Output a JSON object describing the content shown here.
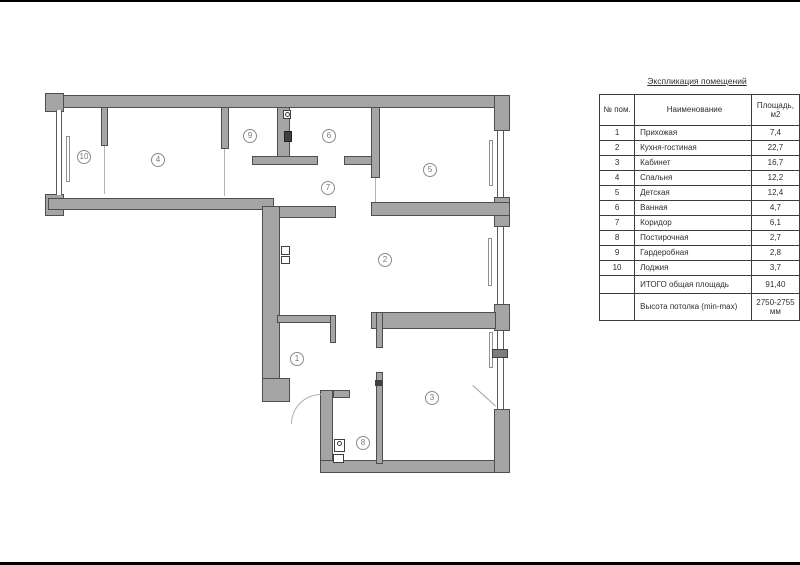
{
  "title": "Экспликация помещений",
  "plan": {
    "labels": [
      {
        "num": "10"
      },
      {
        "num": "4"
      },
      {
        "num": "9"
      },
      {
        "num": "6"
      },
      {
        "num": "5"
      },
      {
        "num": "7"
      },
      {
        "num": "2"
      },
      {
        "num": "1"
      },
      {
        "num": "8"
      },
      {
        "num": "3"
      }
    ]
  },
  "table": {
    "columns": [
      "№ пом.",
      "Наименование",
      "Площадь, м2"
    ],
    "rows": [
      [
        "1",
        "Прихожая",
        "7,4"
      ],
      [
        "2",
        "Кухня-гостиная",
        "22,7"
      ],
      [
        "3",
        "Кабинет",
        "16,7"
      ],
      [
        "4",
        "Спальня",
        "12,2"
      ],
      [
        "5",
        "Детская",
        "12,4"
      ],
      [
        "6",
        "Ванная",
        "4,7"
      ],
      [
        "7",
        "Коридор",
        "6,1"
      ],
      [
        "8",
        "Постирочная",
        "2,7"
      ],
      [
        "9",
        "Гардеробная",
        "2,8"
      ],
      [
        "10",
        "Лоджия",
        "3,7"
      ]
    ],
    "total_label": "ИТОГО общая площадь",
    "total_value": "91,40",
    "ceiling_label": "Высота потолка (min-max)",
    "ceiling_value": "2750-2755 мм"
  },
  "colors": {
    "wall_fill": "#a5a5a5",
    "wall_edge": "#4e4e4e",
    "thin_line": "#9b9b9b",
    "text": "#2e2e2e"
  }
}
